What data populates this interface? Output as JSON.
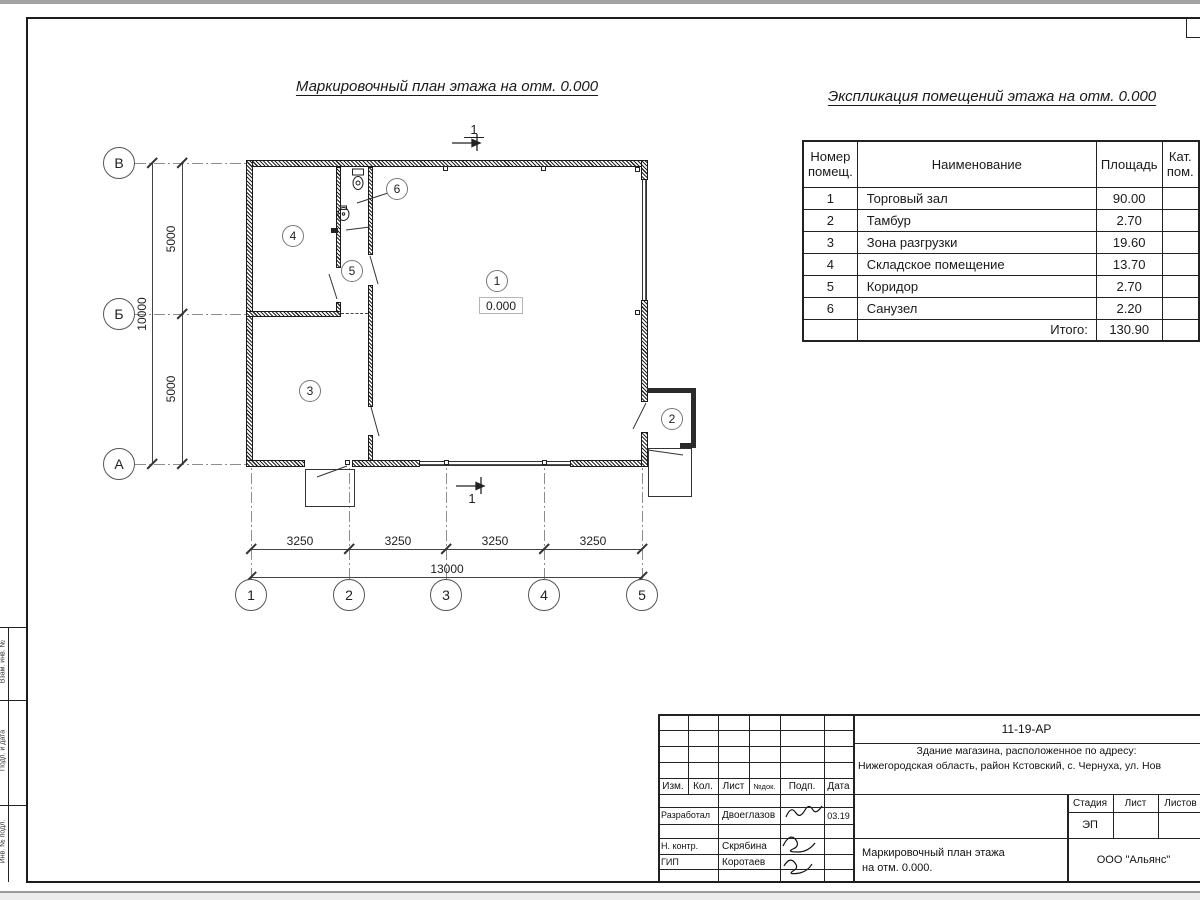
{
  "titles": {
    "plan": "Маркировочный план этажа на отм. 0.000",
    "explication": "Экспликация помещений этажа на отм. 0.000"
  },
  "plan": {
    "section_mark": "1",
    "elevation": "0.000",
    "rooms": {
      "r1": "1",
      "r2": "2",
      "r3": "3",
      "r4": "4",
      "r5": "5",
      "r6": "6"
    },
    "axes": {
      "v1": "В",
      "v2": "Б",
      "v3": "А",
      "h1": "1",
      "h2": "2",
      "h3": "3",
      "h4": "4",
      "h5": "5"
    },
    "dims": {
      "left_top": "5000",
      "left_bottom": "5000",
      "left_total": "10000",
      "b1": "3250",
      "b2": "3250",
      "b3": "3250",
      "b4": "3250",
      "total": "13000"
    }
  },
  "explication": {
    "headers": {
      "num": "Номер помещ.",
      "name": "Наименование",
      "area": "Площадь",
      "cat": "Кат. пом."
    },
    "rows": [
      {
        "num": "1",
        "name": "Торговый зал",
        "area": "90.00"
      },
      {
        "num": "2",
        "name": "Тамбур",
        "area": "2.70"
      },
      {
        "num": "3",
        "name": "Зона разгрузки",
        "area": "19.60"
      },
      {
        "num": "4",
        "name": "Складское помещение",
        "area": "13.70"
      },
      {
        "num": "5",
        "name": "Коридор",
        "area": "2.70"
      },
      {
        "num": "6",
        "name": "Санузел",
        "area": "2.20"
      }
    ],
    "total_label": "Итого:",
    "total_area": "130.90"
  },
  "titleblock": {
    "doc_number": "11-19-АР",
    "project_line1": "Здание магазина, расположенное по адресу:",
    "project_line2": "Нижегородская область, район Кстовский, с. Чернуха, ул. Нов",
    "cols": {
      "izm": "Изм.",
      "kol": "Кол.",
      "list": "Лист",
      "ndok": "№док.",
      "podp": "Подп.",
      "data": "Дата"
    },
    "roles": {
      "dev_label": "Разработал",
      "dev_name": "Двоеглазов",
      "dev_date": "03.19",
      "ncontr_label": "Н. контр.",
      "ncontr_name": "Скрябина",
      "gip_label": "ГИП",
      "gip_name": "Коротаев"
    },
    "stage": {
      "stage_label": "Стадия",
      "list_label": "Лист",
      "listov_label": "Листов",
      "stage_value": "ЭП"
    },
    "drawing_title_1": "Маркировочный план этажа",
    "drawing_title_2": "на отм. 0.000.",
    "company": "ООО \"Альянс\""
  },
  "side_stamp": {
    "s1": "Взам. инв. №",
    "s2": "Подп. и дата",
    "s3": "Инв. № подл."
  }
}
